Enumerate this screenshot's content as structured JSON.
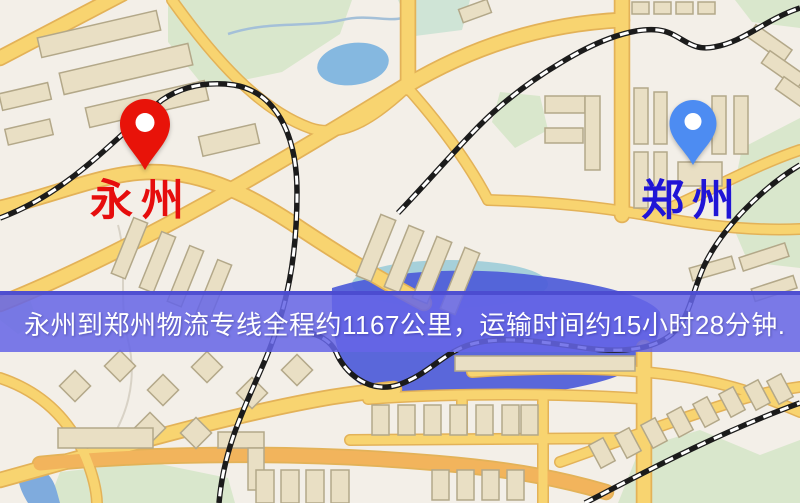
{
  "page": {
    "type": "logistics-route-map",
    "width": 800,
    "height": 503
  },
  "banner": {
    "text": "永州到郑州物流专线全程约1167公里，运输时间约15小时28分钟.",
    "bg_color": "#6565e6",
    "text_color": "#ffffff"
  },
  "route": {
    "origin": "永州",
    "destination": "郑州",
    "distance_text": "约1167公里",
    "duration_text": "约15小时28分钟"
  },
  "markers": {
    "origin": {
      "label": "永州",
      "icon": "location-pin",
      "pin_color": "#e81309",
      "label_color": "#e60d0d"
    },
    "destination": {
      "label": "郑州",
      "icon": "location-pin",
      "pin_color": "#4d8cf2",
      "label_color": "#2015d6"
    }
  },
  "map_colors": {
    "background": "#f3efe8",
    "road_fill": "#f8d470",
    "road_casing": "#e3b258",
    "road_orange": "#f2b45c",
    "building": "#e9dfc4",
    "building_outline": "#b3a889",
    "park": "#d9e7cc",
    "water_light": "#85b8e0",
    "water_deep": "#4e5cd8",
    "railway_dark": "#1b1b1b",
    "railway_light": "#ffffff"
  }
}
